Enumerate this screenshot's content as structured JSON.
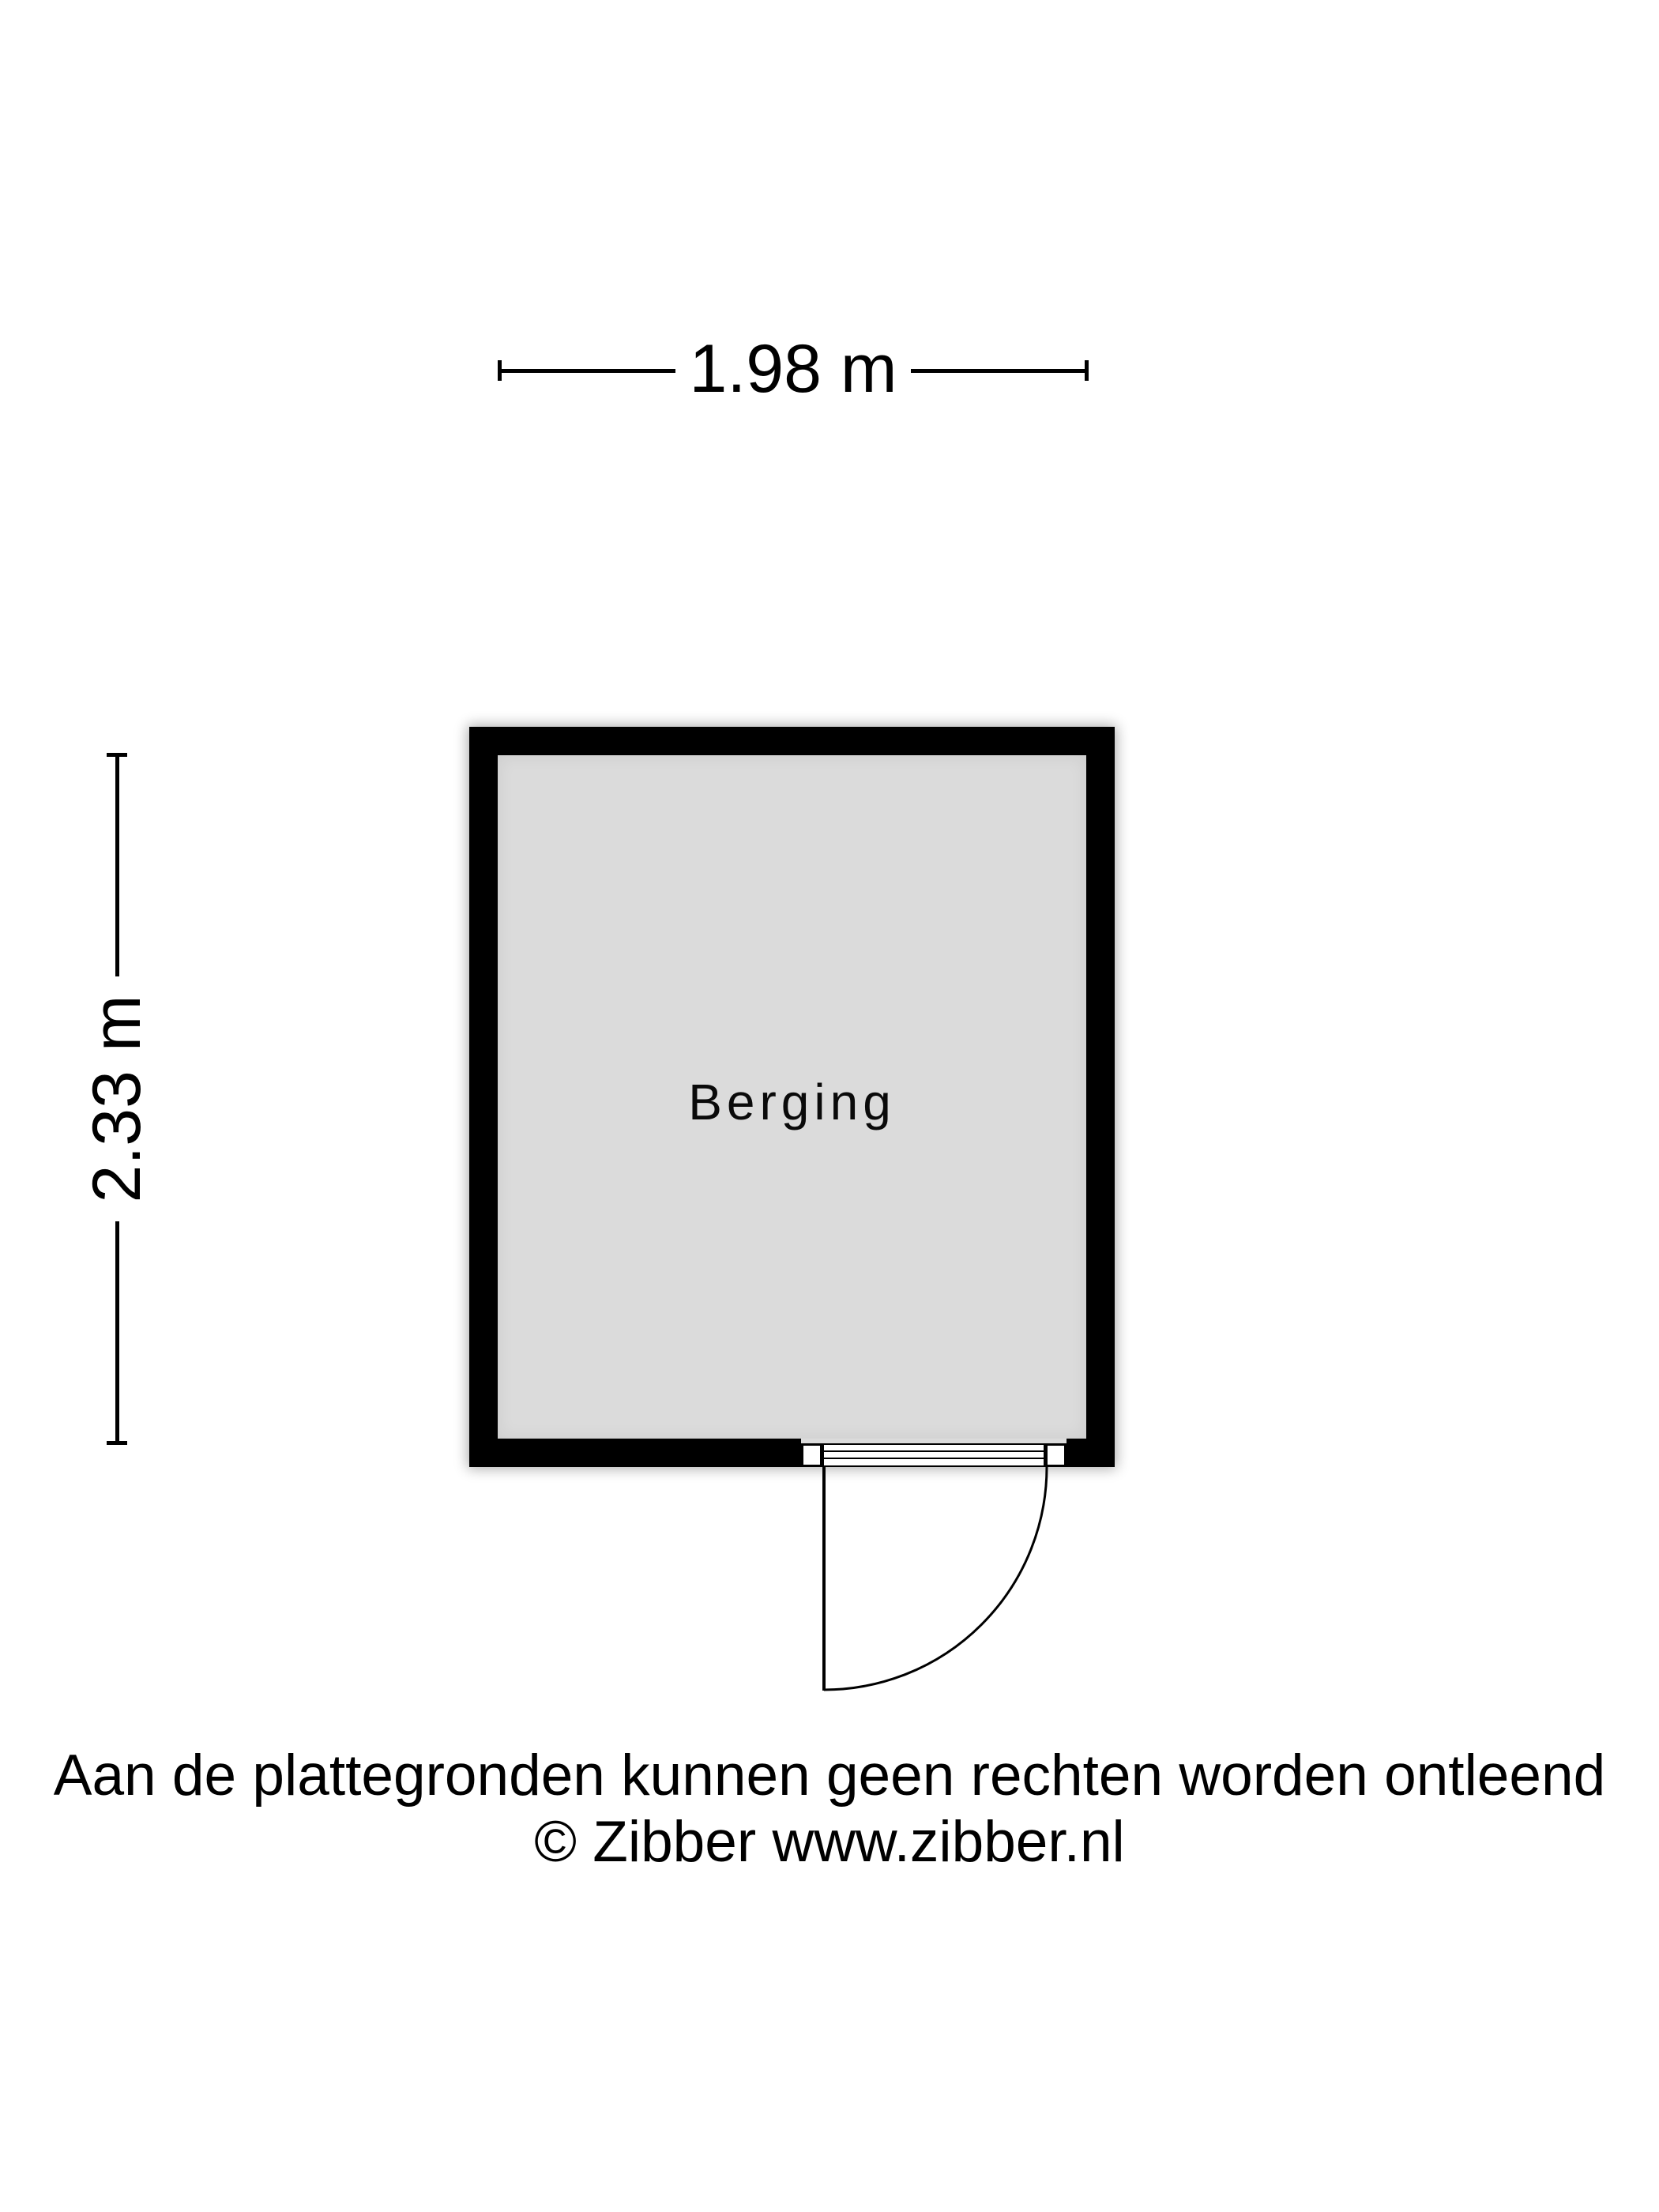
{
  "dimensions": {
    "width": {
      "label": "1.98 m"
    },
    "height": {
      "label": "2.33 m"
    }
  },
  "room": {
    "label": "Berging"
  },
  "footer": {
    "disclaimer": "Aan de plattegronden kunnen geen rechten worden ontleend",
    "copyright": "© Zibber www.zibber.nl"
  },
  "colors": {
    "wall": "#000000",
    "floor": "#dbdbdb",
    "line": "#000000",
    "text": "#000000",
    "background": "#ffffff",
    "door": "#ffffff"
  }
}
